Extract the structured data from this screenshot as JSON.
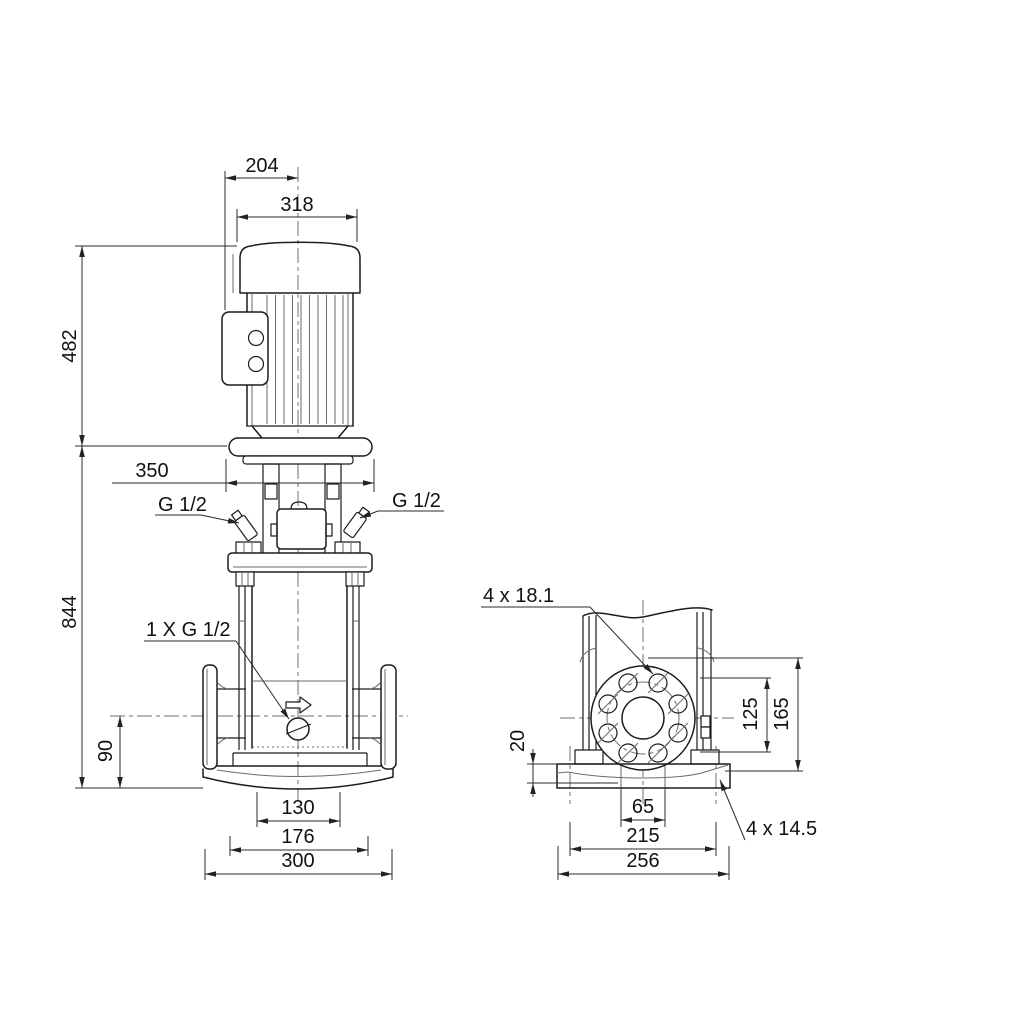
{
  "title": "Pump dimensional drawing",
  "colors": {
    "background": "#ffffff",
    "outline": "#1c1c1c",
    "thin_line": "#6a6a6a",
    "dimension_line": "#2b2b2b",
    "text": "#111111"
  },
  "front_view": {
    "dim_box_to_center": "204",
    "dim_motor_width": "318",
    "dim_motor_height": "482",
    "dim_total_height": "844",
    "dim_clearance": "350",
    "dim_port_height": "90",
    "label_plug_left": "G 1/2",
    "label_plug_right": "G 1/2",
    "label_drain_plug": "1 X G 1/2",
    "dim_base_inner": "130",
    "dim_base_mid": "176",
    "dim_base_outer": "300"
  },
  "side_view": {
    "label_flange_holes": "4 x 18.1",
    "dim_base_thickness": "20",
    "dim_bolt_circle": "125",
    "dim_flange_od": "165",
    "dim_port_bore": "65",
    "dim_base_hole_cc": "215",
    "dim_base_width": "256",
    "label_base_holes": "4 x 14.5"
  }
}
